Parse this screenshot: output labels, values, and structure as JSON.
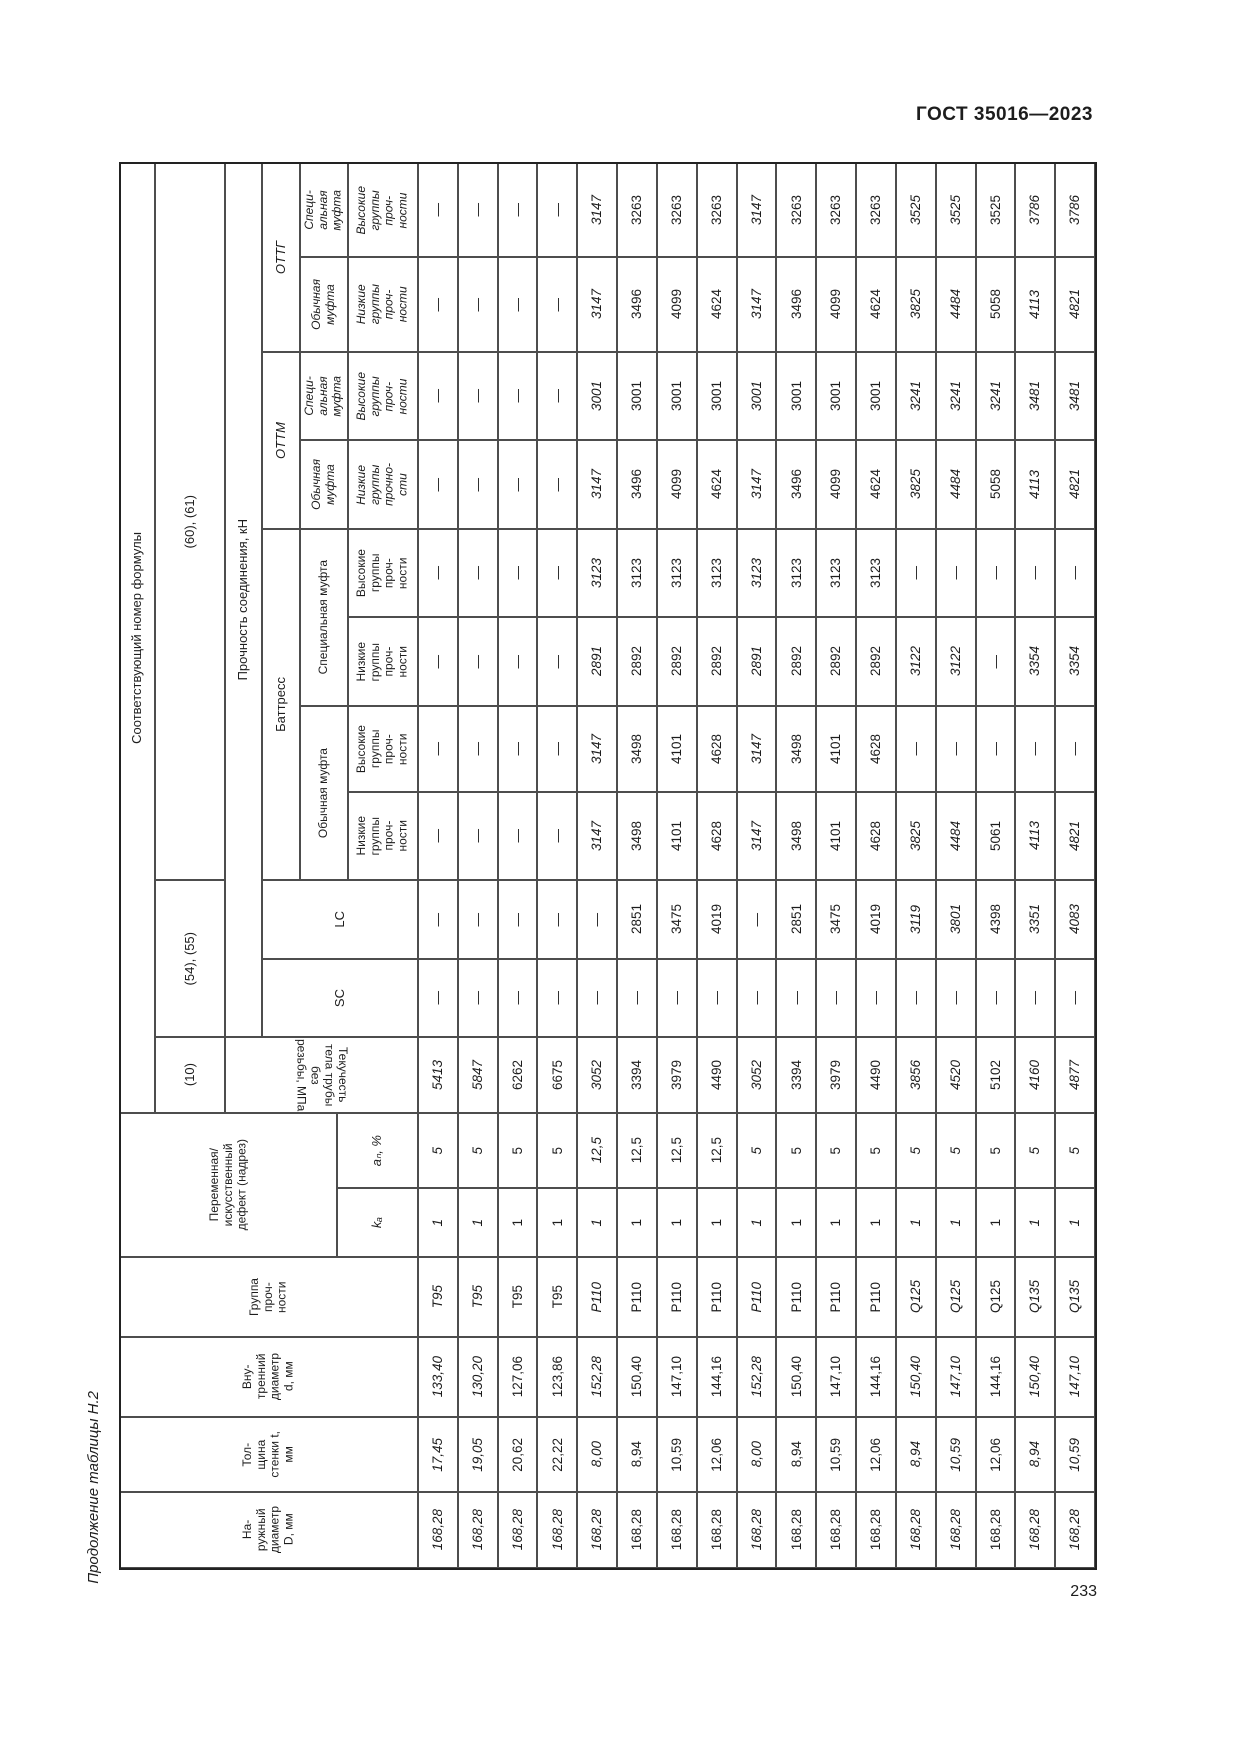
{
  "page": {
    "standard": "ГОСТ 35016—2023",
    "caption": "Продолжение таблицы Н.2",
    "page_number": "233"
  },
  "table": {
    "dash": "—",
    "header": {
      "formula_col": "Соответствующий номер формулы",
      "formula_60_61": "(60), (61)",
      "formula_54_55": "(54), (55)",
      "formula_10": "(10)",
      "strength_label": "Прочность соединения, кН",
      "yield_label": "Текучесть тела трубы без\nрезьбы, МПа",
      "ottg": "ОТТГ",
      "ottm": "ОТТМ",
      "buttress": "Баттресс",
      "lc": "LC",
      "sc": "SC",
      "special_coupling_short": "Специ-\nальная\nмуфта",
      "regular_coupling_short": "Обычная\nмуфта",
      "special_coupling": "Специальная муфта",
      "regular_coupling": "Обычная муфта",
      "high_groups": "Высокие\nгруппы\nпроч-\nности",
      "low_groups": "Низкие\nгруппы\nпроч-\nности",
      "low_groups_alt": "Низкие\nгруппы\nпрочно-\nсти",
      "defect": "Переменная/\nискусственный\nдефект (надрез)",
      "an": "aₙ, %",
      "ka": "kₐ",
      "group": "Группа\nпроч-\nности",
      "inner_diameter": "Вну-\nтренний\nдиаметр\nd, мм",
      "wall": "Тол-\nщина\nстенки t,\nмм",
      "outer_diameter": "На-\nружный\nдиаметр\nD, мм"
    },
    "italic_extra": [
      {
        "row": 2,
        "field": "d"
      },
      {
        "row": 3,
        "field": "d"
      },
      {
        "row": 14,
        "field": "ottm_sm_v"
      }
    ],
    "rows": [
      {
        "d": "168,28",
        "t": "17,45",
        "di": "133,40",
        "group": "T95",
        "ka": "1",
        "an": "5",
        "yield": "5413",
        "sc": "—",
        "lc": "—",
        "b_om_n": "—",
        "b_om_v": "—",
        "b_sm_n": "—",
        "b_sm_v": "—",
        "ottm_om_n": "—",
        "ottm_sm_v": "—",
        "ottg_om_n": "—",
        "ottg_sm_v": "—",
        "italic": true
      },
      {
        "d": "168,28",
        "t": "19,05",
        "di": "130,20",
        "group": "T95",
        "ka": "1",
        "an": "5",
        "yield": "5847",
        "sc": "—",
        "lc": "—",
        "b_om_n": "—",
        "b_om_v": "—",
        "b_sm_n": "—",
        "b_sm_v": "—",
        "ottm_om_n": "—",
        "ottm_sm_v": "—",
        "ottg_om_n": "—",
        "ottg_sm_v": "—",
        "italic": true
      },
      {
        "d": "168,28",
        "t": "20,62",
        "di": "127,06",
        "group": "T95",
        "ka": "1",
        "an": "5",
        "yield": "6262",
        "sc": "—",
        "lc": "—",
        "b_om_n": "—",
        "b_om_v": "—",
        "b_sm_n": "—",
        "b_sm_v": "—",
        "ottm_om_n": "—",
        "ottm_sm_v": "—",
        "ottg_om_n": "—",
        "ottg_sm_v": "—",
        "italic": false
      },
      {
        "d": "168,28",
        "t": "22,22",
        "di": "123,86",
        "group": "T95",
        "ka": "1",
        "an": "5",
        "yield": "6675",
        "sc": "—",
        "lc": "—",
        "b_om_n": "—",
        "b_om_v": "—",
        "b_sm_n": "—",
        "b_sm_v": "—",
        "ottm_om_n": "—",
        "ottm_sm_v": "—",
        "ottg_om_n": "—",
        "ottg_sm_v": "—",
        "italic": false
      },
      {
        "d": "168,28",
        "t": "8,00",
        "di": "152,28",
        "group": "P110",
        "ka": "1",
        "an": "12,5",
        "yield": "3052",
        "sc": "—",
        "lc": "—",
        "b_om_n": "3147",
        "b_om_v": "3147",
        "b_sm_n": "2891",
        "b_sm_v": "3123",
        "ottm_om_n": "3147",
        "ottm_sm_v": "3001",
        "ottg_om_n": "3147",
        "ottg_sm_v": "3147",
        "italic": true
      },
      {
        "d": "168,28",
        "t": "8,94",
        "di": "150,40",
        "group": "P110",
        "ka": "1",
        "an": "12,5",
        "yield": "3394",
        "sc": "—",
        "lc": "2851",
        "b_om_n": "3498",
        "b_om_v": "3498",
        "b_sm_n": "2892",
        "b_sm_v": "3123",
        "ottm_om_n": "3496",
        "ottm_sm_v": "3001",
        "ottg_om_n": "3496",
        "ottg_sm_v": "3263",
        "italic": false
      },
      {
        "d": "168,28",
        "t": "10,59",
        "di": "147,10",
        "group": "P110",
        "ka": "1",
        "an": "12,5",
        "yield": "3979",
        "sc": "—",
        "lc": "3475",
        "b_om_n": "4101",
        "b_om_v": "4101",
        "b_sm_n": "2892",
        "b_sm_v": "3123",
        "ottm_om_n": "4099",
        "ottm_sm_v": "3001",
        "ottg_om_n": "4099",
        "ottg_sm_v": "3263",
        "italic": false
      },
      {
        "d": "168,28",
        "t": "12,06",
        "di": "144,16",
        "group": "P110",
        "ka": "1",
        "an": "12,5",
        "yield": "4490",
        "sc": "—",
        "lc": "4019",
        "b_om_n": "4628",
        "b_om_v": "4628",
        "b_sm_n": "2892",
        "b_sm_v": "3123",
        "ottm_om_n": "4624",
        "ottm_sm_v": "3001",
        "ottg_om_n": "4624",
        "ottg_sm_v": "3263",
        "italic": false
      },
      {
        "d": "168,28",
        "t": "8,00",
        "di": "152,28",
        "group": "P110",
        "ka": "1",
        "an": "5",
        "yield": "3052",
        "sc": "—",
        "lc": "—",
        "b_om_n": "3147",
        "b_om_v": "3147",
        "b_sm_n": "2891",
        "b_sm_v": "3123",
        "ottm_om_n": "3147",
        "ottm_sm_v": "3001",
        "ottg_om_n": "3147",
        "ottg_sm_v": "3147",
        "italic": true
      },
      {
        "d": "168,28",
        "t": "8,94",
        "di": "150,40",
        "group": "P110",
        "ka": "1",
        "an": "5",
        "yield": "3394",
        "sc": "—",
        "lc": "2851",
        "b_om_n": "3498",
        "b_om_v": "3498",
        "b_sm_n": "2892",
        "b_sm_v": "3123",
        "ottm_om_n": "3496",
        "ottm_sm_v": "3001",
        "ottg_om_n": "3496",
        "ottg_sm_v": "3263",
        "italic": false
      },
      {
        "d": "168,28",
        "t": "10,59",
        "di": "147,10",
        "group": "P110",
        "ka": "1",
        "an": "5",
        "yield": "3979",
        "sc": "—",
        "lc": "3475",
        "b_om_n": "4101",
        "b_om_v": "4101",
        "b_sm_n": "2892",
        "b_sm_v": "3123",
        "ottm_om_n": "4099",
        "ottm_sm_v": "3001",
        "ottg_om_n": "4099",
        "ottg_sm_v": "3263",
        "italic": false
      },
      {
        "d": "168,28",
        "t": "12,06",
        "di": "144,16",
        "group": "P110",
        "ka": "1",
        "an": "5",
        "yield": "4490",
        "sc": "—",
        "lc": "4019",
        "b_om_n": "4628",
        "b_om_v": "4628",
        "b_sm_n": "2892",
        "b_sm_v": "3123",
        "ottm_om_n": "4624",
        "ottm_sm_v": "3001",
        "ottg_om_n": "4624",
        "ottg_sm_v": "3263",
        "italic": false
      },
      {
        "d": "168,28",
        "t": "8,94",
        "di": "150,40",
        "group": "Q125",
        "ka": "1",
        "an": "5",
        "yield": "3856",
        "sc": "—",
        "lc": "3119",
        "b_om_n": "3825",
        "b_om_v": "—",
        "b_sm_n": "3122",
        "b_sm_v": "—",
        "ottm_om_n": "3825",
        "ottm_sm_v": "3241",
        "ottg_om_n": "3825",
        "ottg_sm_v": "3525",
        "italic": true
      },
      {
        "d": "168,28",
        "t": "10,59",
        "di": "147,10",
        "group": "Q125",
        "ka": "1",
        "an": "5",
        "yield": "4520",
        "sc": "—",
        "lc": "3801",
        "b_om_n": "4484",
        "b_om_v": "—",
        "b_sm_n": "3122",
        "b_sm_v": "—",
        "ottm_om_n": "4484",
        "ottm_sm_v": "3241",
        "ottg_om_n": "4484",
        "ottg_sm_v": "3525",
        "italic": true
      },
      {
        "d": "168,28",
        "t": "12,06",
        "di": "144,16",
        "group": "Q125",
        "ka": "1",
        "an": "5",
        "yield": "5102",
        "sc": "—",
        "lc": "4398",
        "b_om_n": "5061",
        "b_om_v": "—",
        "b_sm_n": "—",
        "b_sm_v": "—",
        "ottm_om_n": "5058",
        "ottm_sm_v": "3241",
        "ottg_om_n": "5058",
        "ottg_sm_v": "3525",
        "italic": false
      },
      {
        "d": "168,28",
        "t": "8,94",
        "di": "150,40",
        "group": "Q135",
        "ka": "1",
        "an": "5",
        "yield": "4160",
        "sc": "—",
        "lc": "3351",
        "b_om_n": "4113",
        "b_om_v": "—",
        "b_sm_n": "3354",
        "b_sm_v": "—",
        "ottm_om_n": "4113",
        "ottm_sm_v": "3481",
        "ottg_om_n": "4113",
        "ottg_sm_v": "3786",
        "italic": true
      },
      {
        "d": "168,28",
        "t": "10,59",
        "di": "147,10",
        "group": "Q135",
        "ka": "1",
        "an": "5",
        "yield": "4877",
        "sc": "—",
        "lc": "4083",
        "b_om_n": "4821",
        "b_om_v": "—",
        "b_sm_n": "3354",
        "b_sm_v": "—",
        "ottm_om_n": "4821",
        "ottm_sm_v": "3481",
        "ottg_om_n": "4821",
        "ottg_sm_v": "3786",
        "italic": true
      }
    ]
  }
}
